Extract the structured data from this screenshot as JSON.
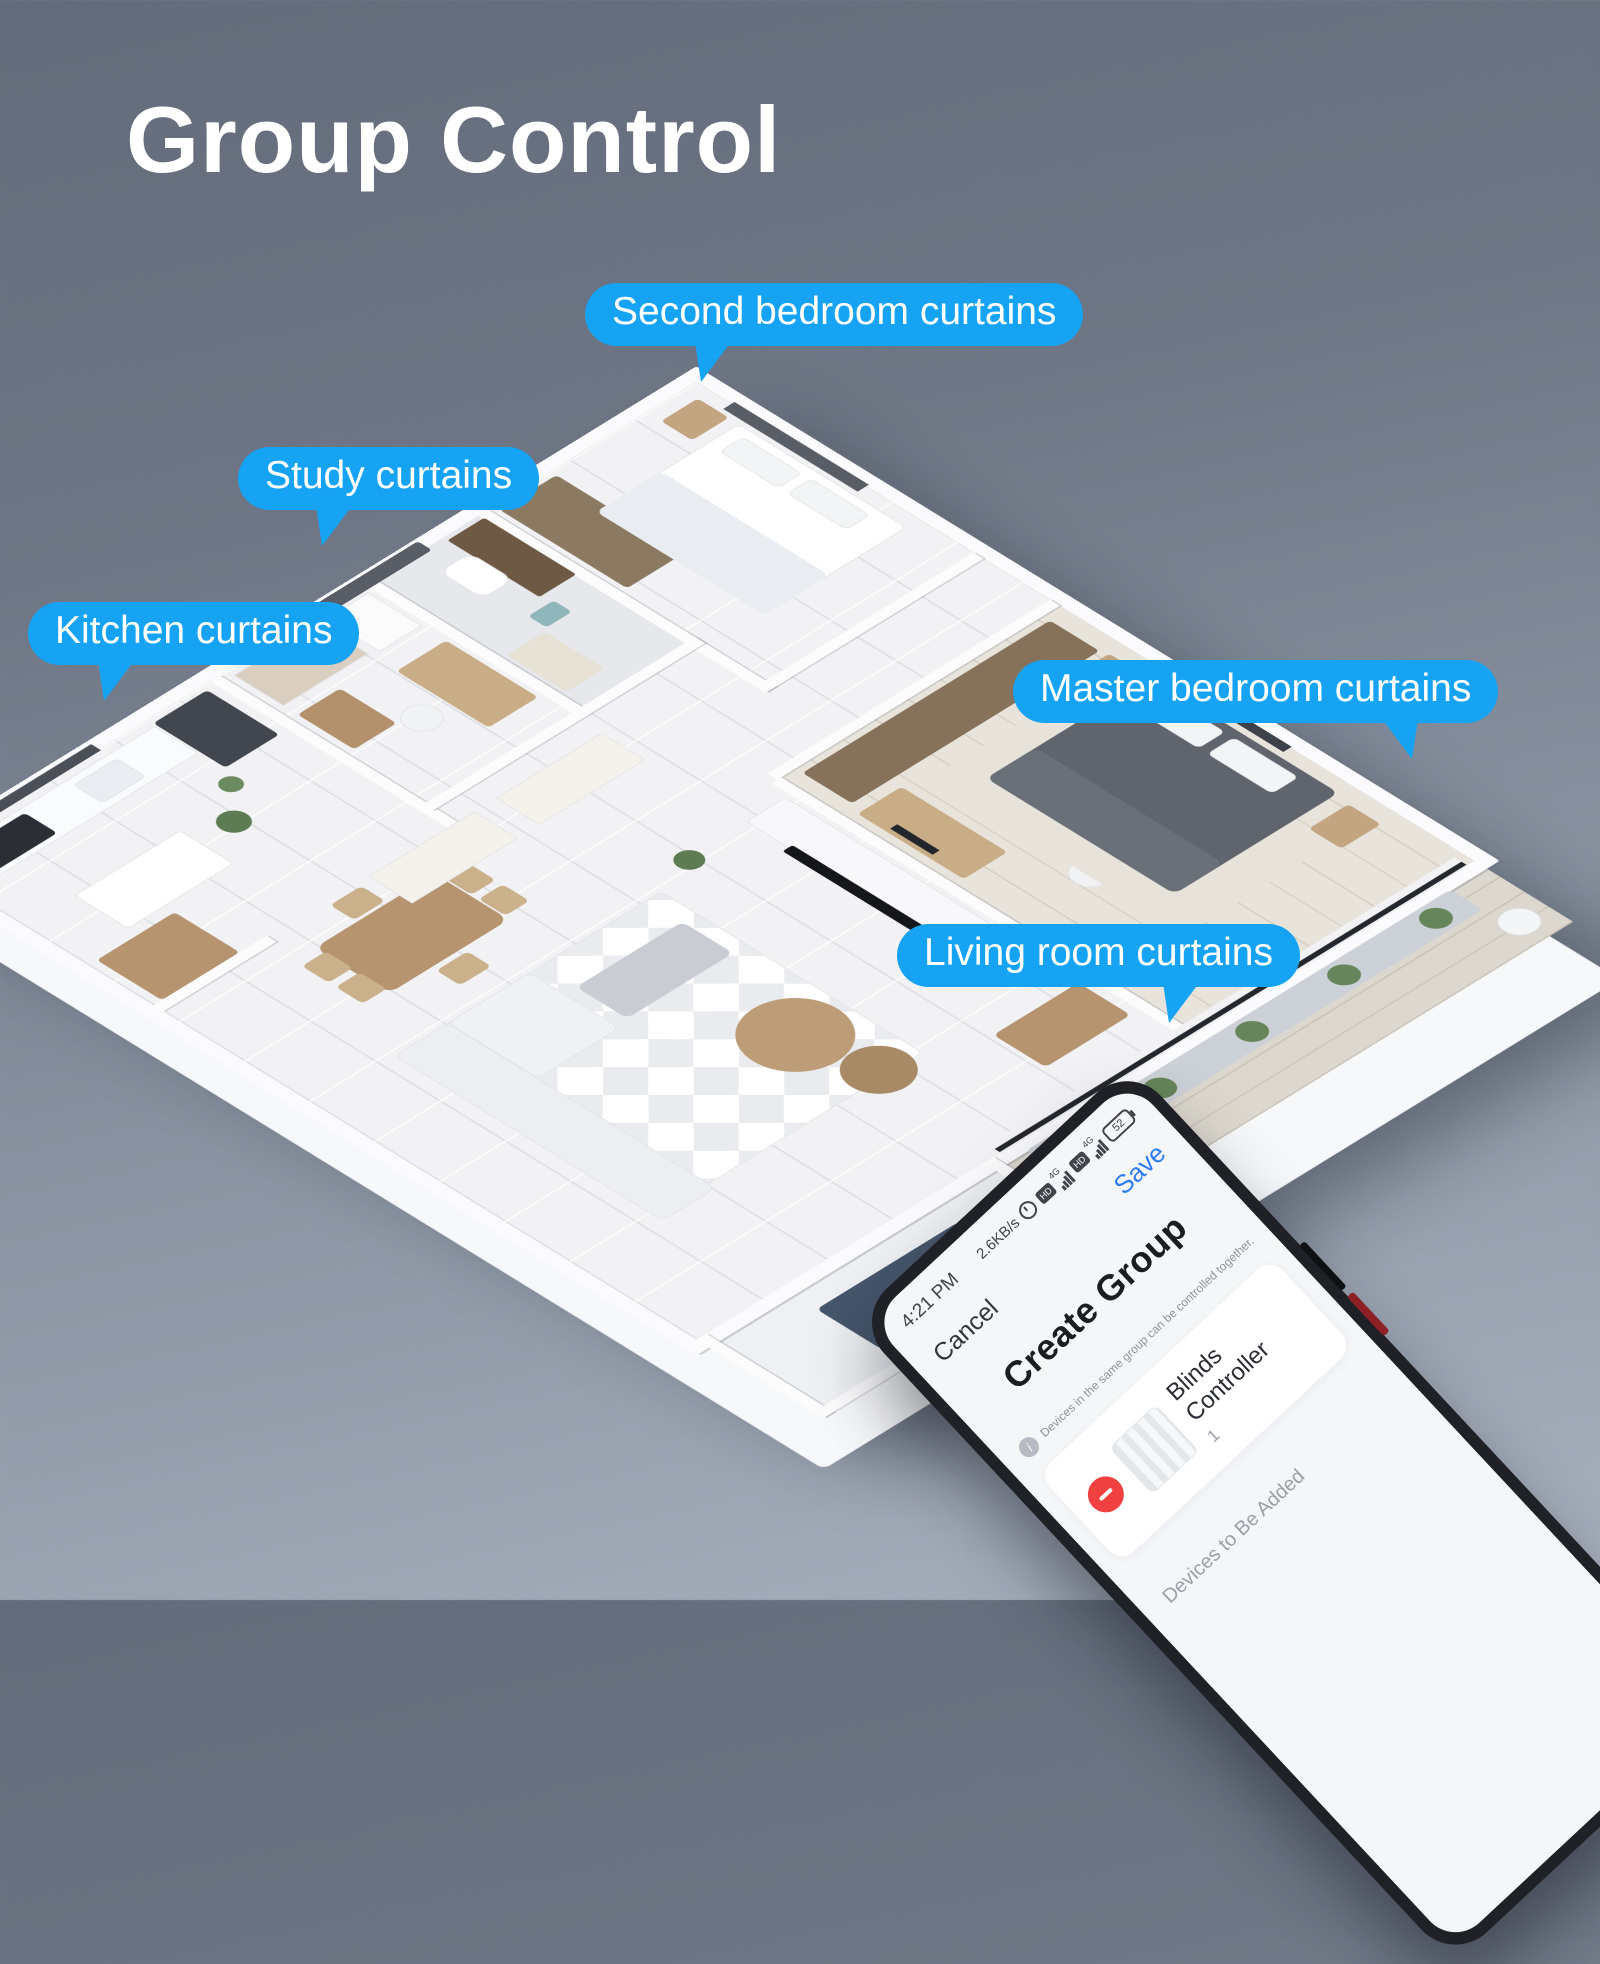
{
  "page": {
    "title": "Group Control"
  },
  "theme": {
    "bubble_blue": "#16a3f3",
    "save_blue": "#2f7cf0",
    "remove_red": "#f04040",
    "background_top": "#646c7b",
    "background_bottom": "#a9b1bf",
    "callout_text": "#ffffff"
  },
  "callouts": [
    {
      "id": "second-bedroom",
      "label": "Second bedroom curtains"
    },
    {
      "id": "study",
      "label": "Study curtains"
    },
    {
      "id": "kitchen",
      "label": "Kitchen curtains"
    },
    {
      "id": "master-bedroom",
      "label": "Master bedroom curtains"
    },
    {
      "id": "living-room",
      "label": "Living room curtains"
    }
  ],
  "phone": {
    "status": {
      "time": "4:21 PM",
      "net_speed": "2.6KB/s",
      "badge": "HD",
      "sim1": "4G",
      "sim2": "4G",
      "battery": "52"
    },
    "nav": {
      "cancel": "Cancel",
      "save": "Save"
    },
    "screen_title": "Create Group",
    "info_glyph": "i",
    "note": "Devices in the same group can be controlled together.",
    "device": {
      "name": "Blinds Controller",
      "count": "1"
    },
    "section_label": "Devices to Be Added"
  }
}
